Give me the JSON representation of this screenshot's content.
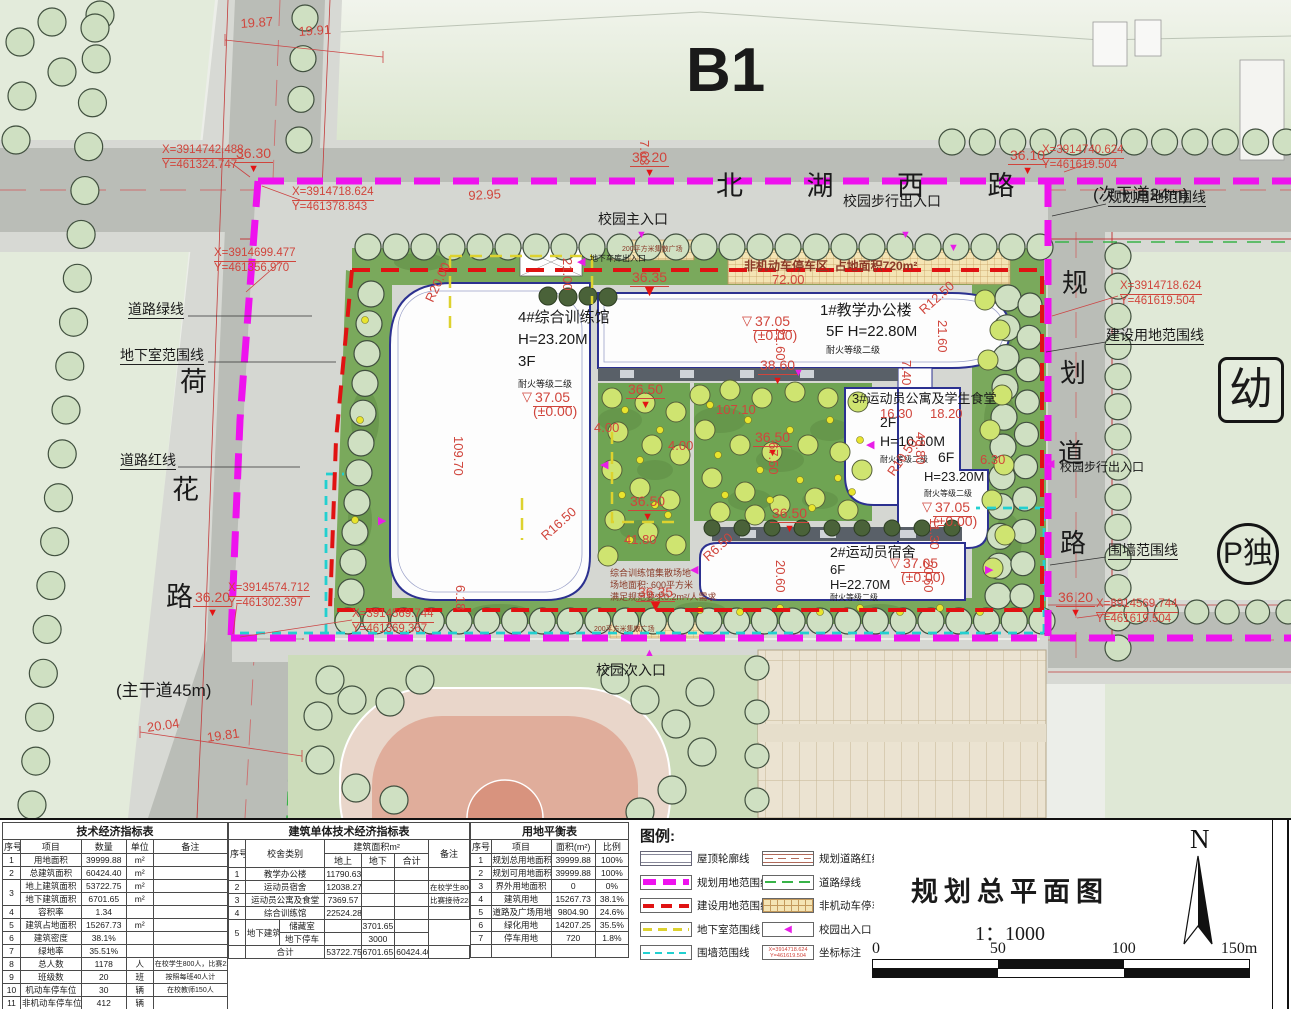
{
  "plan": {
    "labels": [
      {
        "n": "district-label",
        "t": "B1",
        "x": 686,
        "y": 38,
        "s": 62,
        "b": 1
      },
      {
        "n": "road-name-beihuxilu",
        "t": "北 湖 西 路",
        "x": 716,
        "y": 172,
        "s": 27,
        "sp": 28
      },
      {
        "n": "road-type-secondary",
        "t": "(次干道24m)",
        "x": 1093,
        "y": 186,
        "s": 17
      },
      {
        "n": "road-name-hehua-1",
        "t": "荷",
        "x": 180,
        "y": 368,
        "s": 27
      },
      {
        "n": "road-name-hehua-2",
        "t": "花",
        "x": 172,
        "y": 476,
        "s": 27
      },
      {
        "n": "road-name-hehua-3",
        "t": "路",
        "x": 166,
        "y": 583,
        "s": 27
      },
      {
        "n": "road-type-main",
        "t": "(主干道45m)",
        "x": 116,
        "y": 682,
        "s": 17
      },
      {
        "n": "road-name-planned-1",
        "t": "规",
        "x": 1062,
        "y": 270,
        "s": 26
      },
      {
        "n": "road-name-planned-2",
        "t": "划",
        "x": 1060,
        "y": 360,
        "s": 26
      },
      {
        "n": "road-name-planned-3",
        "t": "道",
        "x": 1058,
        "y": 440,
        "s": 26
      },
      {
        "n": "road-name-planned-4",
        "t": "路",
        "x": 1060,
        "y": 530,
        "s": 26
      },
      {
        "n": "line-label-planning-boundary",
        "t": "规划用地范围线",
        "x": 1108,
        "y": 190,
        "s": 14,
        "u": 1
      },
      {
        "n": "line-label-road-green",
        "t": "道路绿线",
        "x": 128,
        "y": 302,
        "s": 14,
        "u": 1
      },
      {
        "n": "line-label-basement",
        "t": "地下室范围线",
        "x": 120,
        "y": 348,
        "s": 14,
        "u": 1
      },
      {
        "n": "line-label-road-red",
        "t": "道路红线",
        "x": 120,
        "y": 453,
        "s": 14,
        "u": 1
      },
      {
        "n": "line-label-construction-boundary",
        "t": "建设用地范围线",
        "x": 1106,
        "y": 328,
        "s": 14,
        "u": 1
      },
      {
        "n": "line-label-wall-boundary",
        "t": "围墙范围线",
        "x": 1108,
        "y": 543,
        "s": 14,
        "u": 1
      },
      {
        "n": "entrance-main-label",
        "t": "校园主入口",
        "x": 598,
        "y": 212,
        "s": 14
      },
      {
        "n": "entrance-pedestrian-north-label",
        "t": "校园步行出入口",
        "x": 843,
        "y": 194,
        "s": 14
      },
      {
        "n": "entrance-pedestrian-east-label",
        "t": "校园步行出入口",
        "x": 1060,
        "y": 461,
        "s": 12
      },
      {
        "n": "entrance-secondary-label",
        "t": "校园次入口",
        "x": 596,
        "y": 663,
        "s": 14
      },
      {
        "n": "entrance-garage-label",
        "t": "地下车库出入口",
        "x": 590,
        "y": 255,
        "s": 8
      },
      {
        "n": "parking-area-note",
        "t": "非机动车停车区, 占地面积720m²",
        "x": 744,
        "y": 260,
        "s": 12,
        "c": "#8a3a28",
        "b": 1
      },
      {
        "n": "plaza-note-north",
        "t": "200平方米集散广场",
        "x": 622,
        "y": 246,
        "s": 7,
        "c": "#8a3a28"
      },
      {
        "n": "plaza-note-south",
        "t": "200平方米集散广场",
        "x": 594,
        "y": 626,
        "s": 7,
        "c": "#8a3a28"
      },
      {
        "n": "building4-name",
        "t": "4#综合训练馆",
        "x": 518,
        "y": 310,
        "s": 15
      },
      {
        "n": "building4-height",
        "t": "H=23.20M",
        "x": 518,
        "y": 332,
        "s": 15
      },
      {
        "n": "building4-floors",
        "t": "3F",
        "x": 518,
        "y": 354,
        "s": 15
      },
      {
        "n": "building4-fire-rating",
        "t": "耐火等级二级",
        "x": 518,
        "y": 380,
        "s": 9
      },
      {
        "n": "building1-name",
        "t": "1#教学办公楼",
        "x": 820,
        "y": 303,
        "s": 15
      },
      {
        "n": "building1-floors-height",
        "t": "5F  H=22.80M",
        "x": 826,
        "y": 324,
        "s": 15
      },
      {
        "n": "building1-fire-rating",
        "t": "耐火等级二级",
        "x": 826,
        "y": 346,
        "s": 9
      },
      {
        "n": "building3-name",
        "t": "3#运动员公寓及学生食堂",
        "x": 852,
        "y": 392,
        "s": 13
      },
      {
        "n": "building3-west-floors",
        "t": "2F",
        "x": 880,
        "y": 415,
        "s": 14
      },
      {
        "n": "building3-west-height",
        "t": "H=10.10M",
        "x": 880,
        "y": 434,
        "s": 14
      },
      {
        "n": "building3-west-fire-rating",
        "t": "耐火等级二级",
        "x": 880,
        "y": 456,
        "s": 8
      },
      {
        "n": "building3-east-floors",
        "t": "6F",
        "x": 938,
        "y": 450,
        "s": 14
      },
      {
        "n": "building3-east-height",
        "t": "H=23.20M",
        "x": 924,
        "y": 470,
        "s": 13
      },
      {
        "n": "building3-east-fire-rating",
        "t": "耐火等级二级",
        "x": 924,
        "y": 490,
        "s": 8
      },
      {
        "n": "building2-name",
        "t": "2#运动员宿舍",
        "x": 830,
        "y": 545,
        "s": 14
      },
      {
        "n": "building2-floors",
        "t": "6F",
        "x": 830,
        "y": 563,
        "s": 13
      },
      {
        "n": "building2-height",
        "t": "H=22.70M",
        "x": 830,
        "y": 578,
        "s": 13
      },
      {
        "n": "building2-fire-rating",
        "t": "耐火等级二级",
        "x": 830,
        "y": 594,
        "s": 8
      },
      {
        "n": "training-ground-note-1",
        "t": "综合训练馆集散场地",
        "x": 610,
        "y": 569,
        "s": 9,
        "c": "#8a3a28"
      },
      {
        "n": "training-ground-note-2",
        "t": "场地面积: 600平方米",
        "x": 610,
        "y": 581,
        "s": 9,
        "c": "#8a3a28"
      },
      {
        "n": "training-ground-note-3",
        "t": "满足规范要求0.2m²/人需求",
        "x": 610,
        "y": 593,
        "s": 9,
        "c": "#8a3a28"
      },
      {
        "n": "plot-kindergarten",
        "t": "幼",
        "x": 1218,
        "y": 357,
        "s": 44,
        "box": "rect"
      },
      {
        "n": "plot-parking-standalone",
        "t": "P独",
        "x": 1217,
        "y": 523,
        "s": 30,
        "box": "circle"
      }
    ],
    "elevations": [
      {
        "v": "36.30",
        "x": 234,
        "y": 146
      },
      {
        "v": "36.20",
        "x": 630,
        "y": 150
      },
      {
        "v": "36.10",
        "x": 1008,
        "y": 148
      },
      {
        "v": "37.05",
        "pm": "(±0.00)",
        "x": 522,
        "y": 390,
        "o": 1
      },
      {
        "v": "37.05",
        "pm": "(±0.00)",
        "x": 742,
        "y": 314,
        "o": 1
      },
      {
        "v": "38.60",
        "x": 758,
        "y": 358
      },
      {
        "v": "36.50",
        "x": 626,
        "y": 382
      },
      {
        "v": "36.50",
        "x": 753,
        "y": 430
      },
      {
        "v": "36.50",
        "x": 770,
        "y": 506
      },
      {
        "v": "36.50",
        "x": 628,
        "y": 494
      },
      {
        "v": "36.35",
        "x": 630,
        "y": 270,
        "big": 1
      },
      {
        "v": "36.35",
        "x": 636,
        "y": 585,
        "big": 1
      },
      {
        "v": "37.05",
        "pm": "(±0.00)",
        "x": 890,
        "y": 556,
        "o": 1
      },
      {
        "v": "37.05",
        "pm": "(±0.00)",
        "x": 922,
        "y": 500,
        "o": 1
      },
      {
        "v": "36.20",
        "x": 193,
        "y": 590
      },
      {
        "v": "36.20",
        "x": 1056,
        "y": 590
      }
    ],
    "dims": [
      {
        "t": "19.87",
        "x": 240,
        "y": 16,
        "r": -4
      },
      {
        "t": "19.91",
        "x": 298,
        "y": 24,
        "r": -4
      },
      {
        "t": "7.03",
        "x": 652,
        "y": 140,
        "r": 90
      },
      {
        "t": "92.95",
        "x": 468,
        "y": 188,
        "r": -3
      },
      {
        "t": "72.00",
        "x": 772,
        "y": 272
      },
      {
        "t": "21.00",
        "x": 575,
        "y": 258,
        "r": 90
      },
      {
        "t": "109.70",
        "x": 466,
        "y": 436,
        "r": 90
      },
      {
        "t": "21.60",
        "x": 788,
        "y": 328,
        "r": 90
      },
      {
        "t": "21.60",
        "x": 950,
        "y": 320,
        "r": 90
      },
      {
        "t": "R12.50",
        "x": 916,
        "y": 306,
        "r": -42
      },
      {
        "t": "7.40",
        "x": 914,
        "y": 360,
        "r": 90
      },
      {
        "t": "16.30",
        "x": 880,
        "y": 406
      },
      {
        "t": "18.20",
        "x": 930,
        "y": 406
      },
      {
        "t": "48.80",
        "x": 928,
        "y": 432,
        "r": 90
      },
      {
        "t": "R10.50",
        "x": 884,
        "y": 470,
        "r": -55
      },
      {
        "t": "R20.00",
        "x": 422,
        "y": 298,
        "r": -65
      },
      {
        "t": "R16.50",
        "x": 538,
        "y": 532,
        "r": -42
      },
      {
        "t": "R6.50",
        "x": 700,
        "y": 553,
        "r": -42
      },
      {
        "t": "107.10",
        "x": 716,
        "y": 402
      },
      {
        "t": "67.50",
        "x": 781,
        "y": 442,
        "r": 90
      },
      {
        "t": "4.00",
        "x": 594,
        "y": 420
      },
      {
        "t": "4.00",
        "x": 668,
        "y": 438
      },
      {
        "t": "20.60",
        "x": 788,
        "y": 560,
        "r": 90
      },
      {
        "t": "20.60",
        "x": 936,
        "y": 560,
        "r": 90
      },
      {
        "t": "11.30",
        "x": 942,
        "y": 518,
        "r": 90
      },
      {
        "t": "6.18",
        "x": 468,
        "y": 585,
        "r": 90
      },
      {
        "t": "20.04",
        "x": 146,
        "y": 720,
        "r": -8
      },
      {
        "t": "19.81",
        "x": 206,
        "y": 730,
        "r": -8
      },
      {
        "t": "41.80",
        "x": 624,
        "y": 532
      },
      {
        "t": "6.30",
        "x": 980,
        "y": 452
      }
    ],
    "coords": [
      {
        "l1": "X=3914742.488",
        "l2": "Y=461324.747",
        "x": 162,
        "y": 144
      },
      {
        "l1": "X=3914718.624",
        "l2": "Y=461378.843",
        "x": 292,
        "y": 186
      },
      {
        "l1": "X=3914699.477",
        "l2": "Y=461356.970",
        "x": 214,
        "y": 247
      },
      {
        "l1": "X=3914574.712",
        "l2": "Y=461302.397",
        "x": 228,
        "y": 582
      },
      {
        "l1": "X=3914740.624",
        "l2": "Y=461619.504",
        "x": 1042,
        "y": 144
      },
      {
        "l1": "X=3914718.624",
        "l2": "Y=461619.504",
        "x": 1120,
        "y": 280
      },
      {
        "l1": "X=3914569.744",
        "l2": "Y=461619.504",
        "x": 1096,
        "y": 598
      },
      {
        "l1": "X=3914569.744",
        "l2": "Y=461369.367",
        "x": 352,
        "y": 608
      }
    ],
    "entrance_triangles": [
      {
        "x": 636,
        "y": 230,
        "g": "▼"
      },
      {
        "x": 900,
        "y": 230,
        "g": "▼"
      },
      {
        "x": 644,
        "y": 648,
        "g": "▲"
      },
      {
        "x": 1046,
        "y": 459,
        "g": "◀"
      },
      {
        "x": 577,
        "y": 257,
        "g": "◀"
      },
      {
        "x": 600,
        "y": 460,
        "g": "◀"
      },
      {
        "x": 866,
        "y": 440,
        "g": "◀"
      },
      {
        "x": 690,
        "y": 565,
        "g": "◀"
      },
      {
        "x": 985,
        "y": 565,
        "g": "▶"
      },
      {
        "x": 793,
        "y": 368,
        "g": "▼"
      },
      {
        "x": 948,
        "y": 243,
        "g": "▼"
      },
      {
        "x": 378,
        "y": 516,
        "g": "▶"
      }
    ]
  },
  "tables": [
    {
      "id": "t1",
      "title": "技术经济指标表",
      "ncols": 5,
      "colw": [
        8,
        27,
        20,
        12,
        33
      ],
      "header": [
        [
          "序号",
          "项目",
          "数量",
          "单位",
          "备注"
        ]
      ],
      "rows": [
        [
          "1",
          "用地面积",
          "39999.88",
          "m²",
          ""
        ],
        [
          "2",
          "总建筑面积",
          "60424.40",
          "m²",
          ""
        ],
        [
          {
            "t": "3",
            "rs": 2
          },
          "地上建筑面积",
          "53722.75",
          "m²",
          ""
        ],
        [
          "地下建筑面积",
          "6701.65",
          "m²",
          ""
        ],
        [
          "4",
          "容积率",
          "1.34",
          "",
          ""
        ],
        [
          "5",
          "建筑占地面积",
          "15267.73",
          "m²",
          ""
        ],
        [
          "6",
          "建筑密度",
          "38.1%",
          "",
          ""
        ],
        [
          "7",
          "绿地率",
          "35.51%",
          "",
          ""
        ],
        [
          "8",
          "总人数",
          "1178",
          "人",
          {
            "t": "在校学生800人，比赛228人",
            "f": 7
          }
        ],
        [
          "9",
          "班级数",
          "20",
          "班",
          {
            "t": "按照每班40人计",
            "f": 7
          }
        ],
        [
          "10",
          "机动车停车位",
          "30",
          "辆",
          {
            "t": "在校教师150人",
            "f": 7
          }
        ],
        [
          "11",
          "非机动车停车位",
          "412",
          "辆",
          ""
        ]
      ]
    },
    {
      "id": "t2",
      "title": "建筑单体技术经济指标表",
      "ncols": 7,
      "colw": [
        7,
        14,
        19,
        15,
        14,
        14,
        17
      ],
      "header": [
        [
          {
            "t": "序号",
            "rs": 2
          },
          {
            "t": "校舍类别",
            "rs": 2,
            "cs": 2
          },
          {
            "t": "建筑面积m²",
            "cs": 3
          },
          {
            "t": "备注",
            "rs": 2
          }
        ],
        [
          "地上",
          "地下",
          "合计"
        ]
      ],
      "rows": [
        [
          "1",
          {
            "t": "教学办公楼",
            "cs": 2
          },
          "11790.63",
          "",
          "",
          ""
        ],
        [
          "2",
          {
            "t": "运动员宿舍",
            "cs": 2
          },
          "12038.27",
          "",
          "",
          {
            "t": "在校学生800人",
            "f": 7.5
          }
        ],
        [
          "3",
          {
            "t": "运动员公寓及食堂",
            "cs": 2
          },
          "7369.57",
          "",
          "",
          {
            "t": "比赛接待228人",
            "f": 7.5
          }
        ],
        [
          "4",
          {
            "t": "综合训练馆",
            "cs": 2
          },
          "22524.28",
          "",
          "",
          ""
        ],
        [
          {
            "t": "5",
            "rs": 2
          },
          {
            "t": "地下建筑",
            "rs": 2
          },
          "储藏室",
          "",
          "3701.65",
          ""
        ],
        [
          "地下停车",
          "",
          "3000",
          ""
        ],
        [
          "",
          {
            "t": "合计",
            "cs": 2
          },
          "53722.75",
          "6701.65",
          "60424.40",
          ""
        ]
      ]
    },
    {
      "id": "t3",
      "title": "用地平衡表",
      "ncols": 4,
      "colw": [
        13,
        38,
        28,
        21
      ],
      "header": [
        [
          "序号",
          "项目",
          "面积(m²)",
          "比例"
        ]
      ],
      "rows": [
        [
          "1",
          "规划总用地面积",
          "39999.88",
          "100%"
        ],
        [
          "2",
          "规划可用地面积",
          "39999.88",
          "100%"
        ],
        [
          "3",
          "界外用地面积",
          "0",
          "0%"
        ],
        [
          "4",
          "建筑用地",
          "15267.73",
          "38.1%"
        ],
        [
          "5",
          "道路及广场用地",
          "9804.90",
          "24.6%"
        ],
        [
          "6",
          "绿化用地",
          "14207.25",
          "35.5%"
        ],
        [
          "7",
          "停车用地",
          "720",
          "1.8%"
        ],
        [
          "",
          "",
          "",
          ""
        ]
      ]
    }
  ],
  "legend": {
    "title": "图例:",
    "items_left": [
      {
        "label": "屋顶轮廓线",
        "type": "roof"
      },
      {
        "label": "规划用地范围线",
        "type": "magenta"
      },
      {
        "label": "建设用地范围线",
        "type": "red"
      },
      {
        "label": "地下室范围线",
        "type": "yellow"
      },
      {
        "label": "围墙范围线",
        "type": "cyan"
      }
    ],
    "items_right": [
      {
        "label": "规划道路红线及中心线",
        "type": "roadline"
      },
      {
        "label": "道路绿线",
        "type": "green"
      },
      {
        "label": "非机动车停车场地",
        "type": "hatch"
      },
      {
        "label": "校园出入口",
        "type": "entrance"
      },
      {
        "label": "坐标标注",
        "type": "coord",
        "sample1": "X=3914718.624",
        "sample2": "Y=461619.504"
      }
    ]
  },
  "titleblock": {
    "title": "规划总平面图",
    "scale": "1：1000",
    "north_label": "N",
    "scalebar_labels": [
      "0",
      "50",
      "100",
      "150m"
    ]
  },
  "colors": {
    "planning_boundary": "#ee12ee",
    "construction_boundary": "#e01212",
    "basement_line": "#ddd22f",
    "wall_line": "#22d0d0",
    "road_green_line": "#38b348",
    "annotation_red": "#d0453c"
  }
}
